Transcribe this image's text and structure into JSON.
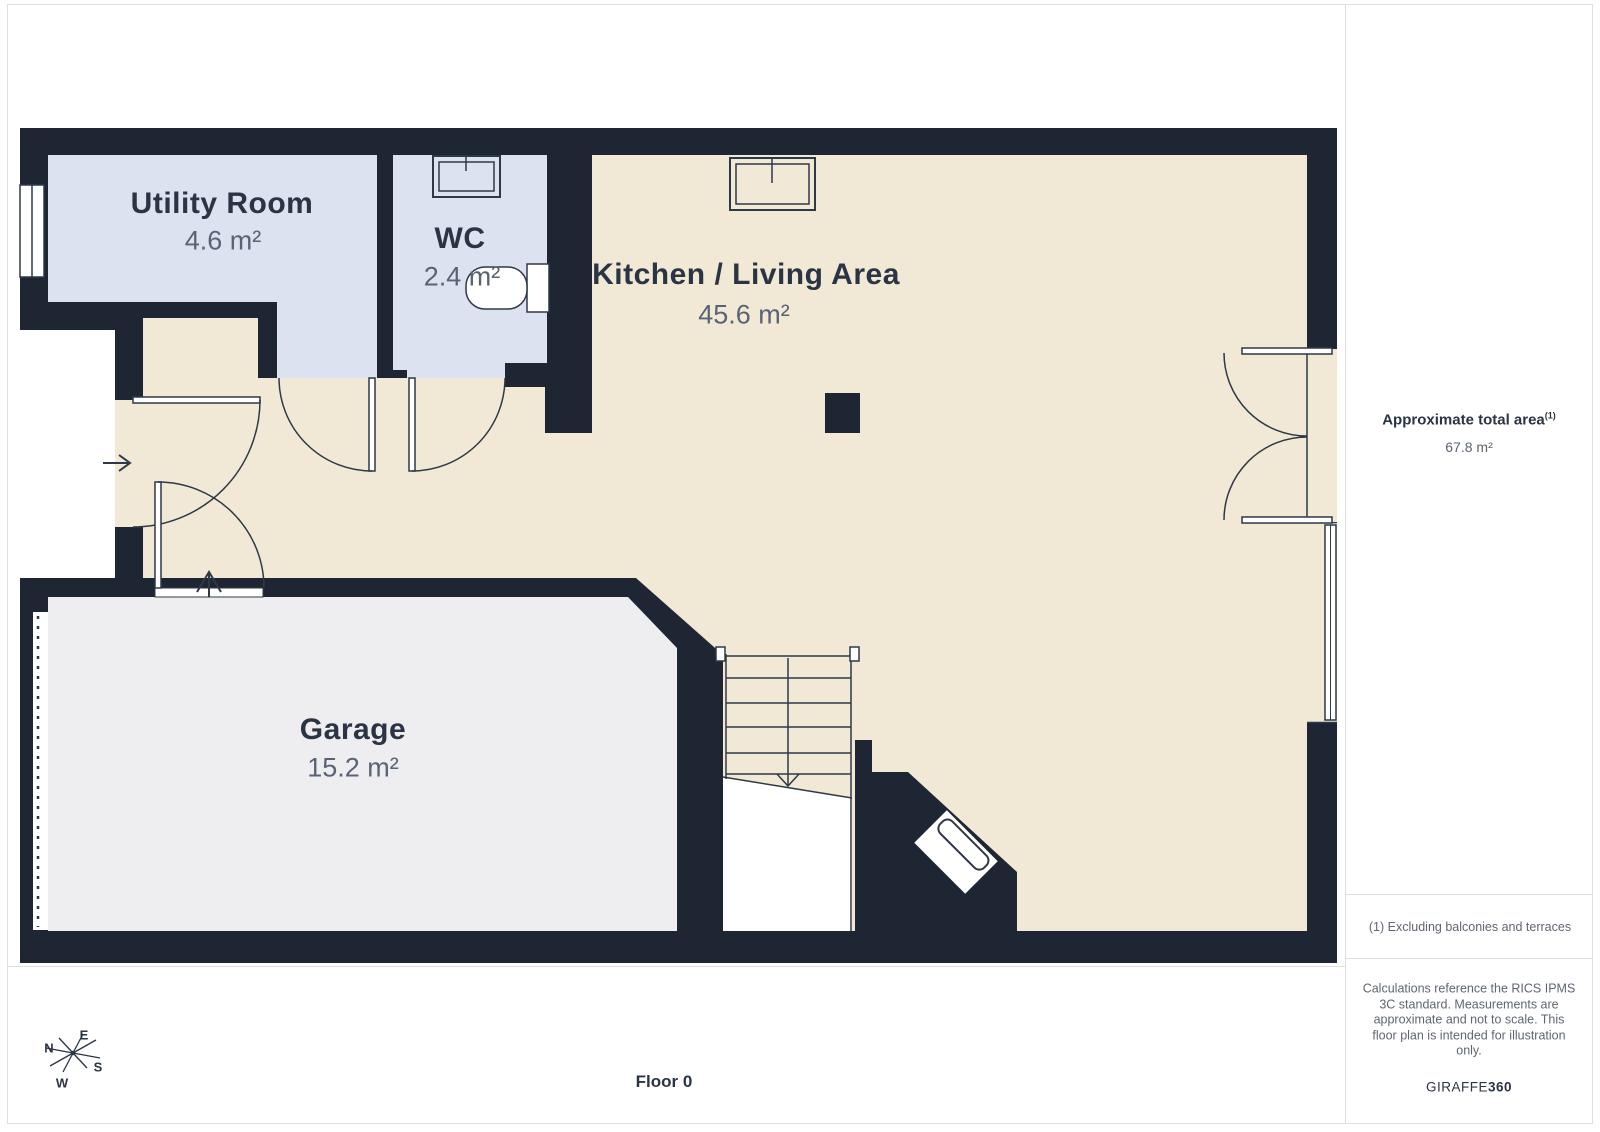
{
  "page": {
    "floor_label": "Floor 0"
  },
  "rooms": [
    {
      "id": "utility",
      "name": "Utility Room",
      "area": "4.6 m²"
    },
    {
      "id": "wc",
      "name": "WC",
      "area": "2.4 m²"
    },
    {
      "id": "kitchen_living",
      "name": "Kitchen / Living Area",
      "area": "45.6 m²"
    },
    {
      "id": "garage",
      "name": "Garage",
      "area": "15.2 m²"
    }
  ],
  "sidebar": {
    "total_area_label": "Approximate total area",
    "total_area_footnote_marker": "(1)",
    "total_area_value": "67.8 m²",
    "footnote": "(1) Excluding balconies and terraces",
    "disclaimer": "Calculations reference the RICS IPMS 3C standard. Measurements are approximate and not to scale. This floor plan is intended for illustration only.",
    "brand_name": "GIRAFFE",
    "brand_suffix": "360"
  },
  "compass": {
    "n": "N",
    "e": "E",
    "s": "S",
    "w": "W"
  },
  "colors": {
    "wall": "#1e2634",
    "room_blue": "#dce2f0",
    "room_cream": "#f1e9d5",
    "room_gray": "#eeeef0",
    "line": "#2e3948",
    "text_primary": "#2b3444",
    "text_secondary": "#5a6375",
    "panel_border": "#dfdfdf"
  }
}
